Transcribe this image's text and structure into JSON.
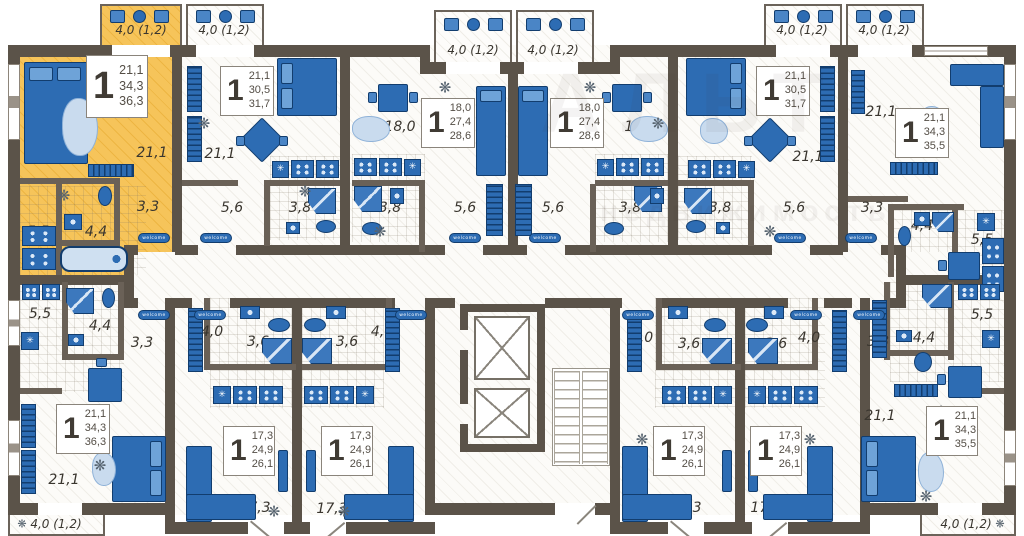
{
  "meta": {
    "type": "residential floor plan",
    "units_visible": 12
  },
  "watermark": {
    "line1": "АЛЬТ",
    "line2": "недвижимость"
  },
  "doormat": "welcome",
  "icons": {
    "washing": "✳",
    "plant": "❋"
  },
  "colors": {
    "wall": "#5b5349",
    "highlight": "#f3c052",
    "furniture": "#2d6cb3",
    "furniture_dark": "#123d6e",
    "rug": "#c9dbee"
  },
  "apartments": [
    {
      "name": "apt-1-top-left-highlighted",
      "rooms": "1",
      "living": "21,1",
      "area": "34,3",
      "total": "36,3",
      "highlighted": true
    },
    {
      "name": "apt-2",
      "rooms": "1",
      "living": "21,1",
      "area": "30,5",
      "total": "31,7",
      "highlighted": false
    },
    {
      "name": "apt-3",
      "rooms": "1",
      "living": "18,0",
      "area": "27,4",
      "total": "28,6",
      "highlighted": false
    },
    {
      "name": "apt-4",
      "rooms": "1",
      "living": "18,0",
      "area": "27,4",
      "total": "28,6",
      "highlighted": false
    },
    {
      "name": "apt-5",
      "rooms": "1",
      "living": "21,1",
      "area": "30,5",
      "total": "31,7",
      "highlighted": false
    },
    {
      "name": "apt-6-top-right",
      "rooms": "1",
      "living": "21,1",
      "area": "34,3",
      "total": "35,5",
      "highlighted": false
    },
    {
      "name": "apt-7-bottom-left",
      "rooms": "1",
      "living": "21,1",
      "area": "34,3",
      "total": "36,3",
      "highlighted": false
    },
    {
      "name": "apt-8",
      "rooms": "1",
      "living": "17,3",
      "area": "24,9",
      "total": "26,1",
      "highlighted": false
    },
    {
      "name": "apt-9",
      "rooms": "1",
      "living": "17,3",
      "area": "24,9",
      "total": "26,1",
      "highlighted": false
    },
    {
      "name": "apt-10",
      "rooms": "1",
      "living": "17,3",
      "area": "24,9",
      "total": "26,1",
      "highlighted": false
    },
    {
      "name": "apt-11",
      "rooms": "1",
      "living": "17,3",
      "area": "24,9",
      "total": "26,1",
      "highlighted": false
    },
    {
      "name": "apt-12-bottom-right",
      "rooms": "1",
      "living": "21,1",
      "area": "34,3",
      "total": "35,5",
      "highlighted": false
    }
  ],
  "room_labels": [
    {
      "room": "apt1-living",
      "text": "21,1"
    },
    {
      "room": "apt1-hall",
      "text": "3,3"
    },
    {
      "room": "apt1-bath",
      "text": "4,4"
    },
    {
      "room": "apt1-kitchen",
      "text": "5,5"
    },
    {
      "room": "apt2-living",
      "text": "21,1"
    },
    {
      "room": "apt2-hall",
      "text": "5,6"
    },
    {
      "room": "apt2-bath",
      "text": "3,8"
    },
    {
      "room": "apt3-living",
      "text": "18,0"
    },
    {
      "room": "apt3-bath",
      "text": "3,8"
    },
    {
      "room": "apt3-hall",
      "text": "5,6"
    },
    {
      "room": "apt4-living",
      "text": "18,0"
    },
    {
      "room": "apt4-hall",
      "text": "5,6"
    },
    {
      "room": "apt4-bath",
      "text": "3,8"
    },
    {
      "room": "apt5-living",
      "text": "21,1"
    },
    {
      "room": "apt5-bath",
      "text": "3,8"
    },
    {
      "room": "apt5-hall",
      "text": "5,6"
    },
    {
      "room": "apt6-living",
      "text": "21,1"
    },
    {
      "room": "apt6-hall",
      "text": "3,3"
    },
    {
      "room": "apt6-bath",
      "text": "4,4"
    },
    {
      "room": "apt6-kitchen",
      "text": "5,5"
    },
    {
      "room": "apt7-kitchen",
      "text": "5,5"
    },
    {
      "room": "apt7-bath",
      "text": "4,4"
    },
    {
      "room": "apt7-hall",
      "text": "3,3"
    },
    {
      "room": "apt7-living",
      "text": "21,1"
    },
    {
      "room": "apt8-hall",
      "text": "4,0"
    },
    {
      "room": "apt8-bath",
      "text": "3,6"
    },
    {
      "room": "apt8-living",
      "text": "17,3"
    },
    {
      "room": "apt9-bath",
      "text": "3,6"
    },
    {
      "room": "apt9-hall",
      "text": "4,0"
    },
    {
      "room": "apt9-living",
      "text": "17,3"
    },
    {
      "room": "apt10-hall",
      "text": "4,0"
    },
    {
      "room": "apt10-bath",
      "text": "3,6"
    },
    {
      "room": "apt10-living",
      "text": "17,3"
    },
    {
      "room": "apt11-bath",
      "text": "3,6"
    },
    {
      "room": "apt11-hall",
      "text": "4,0"
    },
    {
      "room": "apt11-living",
      "text": "17,3"
    },
    {
      "room": "apt12-hall",
      "text": "3,3"
    },
    {
      "room": "apt12-bath",
      "text": "4,4"
    },
    {
      "room": "apt12-kitchen",
      "text": "5,5"
    },
    {
      "room": "apt12-living",
      "text": "21,1"
    }
  ],
  "balcony_labels": [
    {
      "balcony": "top-1",
      "text": "4,0 (1,2)"
    },
    {
      "balcony": "top-2",
      "text": "4,0 (1,2)"
    },
    {
      "balcony": "top-3",
      "text": "4,0 (1,2)"
    },
    {
      "balcony": "top-4",
      "text": "4,0 (1,2)"
    },
    {
      "balcony": "top-5",
      "text": "4,0 (1,2)"
    },
    {
      "balcony": "top-6",
      "text": "4,0 (1,2)"
    },
    {
      "balcony": "bottom-left",
      "text": "4,0 (1,2)"
    },
    {
      "balcony": "bottom-right",
      "text": "4,0 (1,2)"
    }
  ]
}
